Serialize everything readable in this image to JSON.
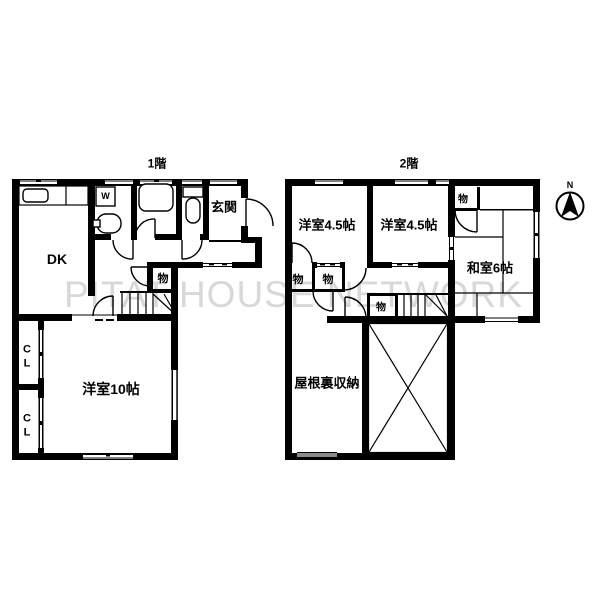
{
  "colors": {
    "wall": "#000000",
    "watermark_gray": "#d8d8d8",
    "window_gray": "#8a8a8a",
    "background": "#ffffff"
  },
  "watermark": {
    "text": "PITAT HOUSE NETWORK"
  },
  "compass": {
    "north_label": "N"
  },
  "floor1": {
    "title": "1階",
    "rooms": {
      "dk": "DK",
      "entrance": "玄関",
      "storage": "物",
      "closet_upper": "CL",
      "closet_lower": "CL",
      "western_room_10": "洋室10帖"
    },
    "fixtures": {
      "washing_machine": "W"
    }
  },
  "floor2": {
    "title": "2階",
    "rooms": {
      "western_left": "洋室4.5帖",
      "western_right": "洋室4.5帖",
      "japanese_room": "和室6帖",
      "storage_top": "物",
      "storage_hall_left": "物",
      "storage_hall_center": "物",
      "storage_hall_right": "物",
      "attic_storage": "屋根裏収納"
    }
  }
}
